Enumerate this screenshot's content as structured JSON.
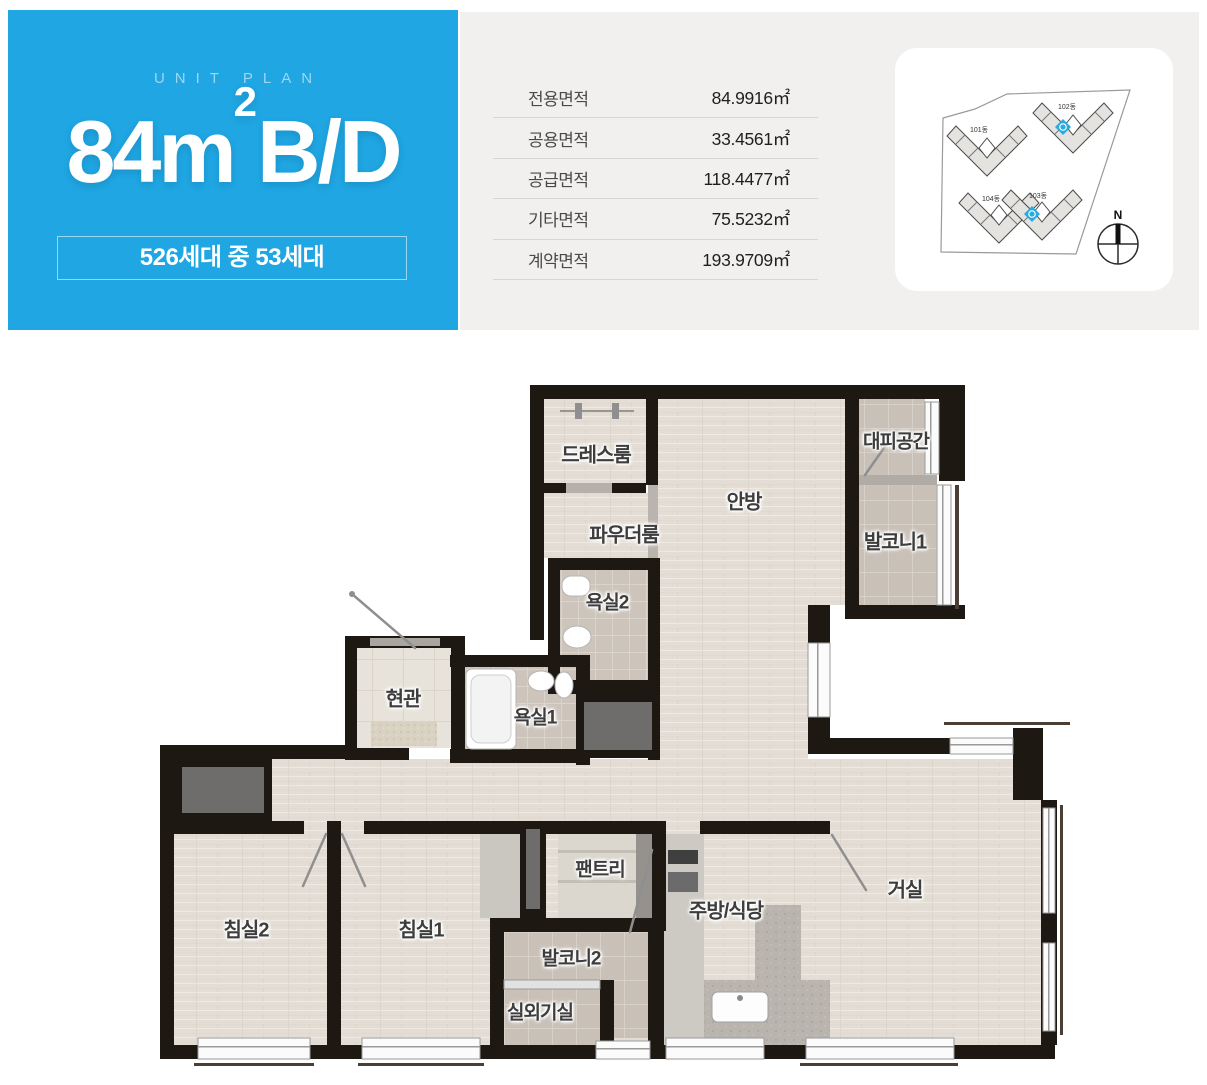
{
  "header": {
    "eyebrow": "UNIT PLAN",
    "unit_name": {
      "base": "84m",
      "sup": "2",
      "suffix": "B/D"
    },
    "badge": "526세대 중 53세대",
    "accent_color": "#1fa6e3"
  },
  "area_table": {
    "rows": [
      {
        "label": "전용면적",
        "value": "84.9916㎡"
      },
      {
        "label": "공용면적",
        "value": "33.4561㎡"
      },
      {
        "label": "공급면적",
        "value": "118.4477㎡"
      },
      {
        "label": "기타면적",
        "value": "75.5232㎡"
      },
      {
        "label": "계약면적",
        "value": "193.9709㎡"
      }
    ]
  },
  "site_plan": {
    "buildings": [
      {
        "name": "101동",
        "highlighted": false
      },
      {
        "name": "102동",
        "highlighted": true
      },
      {
        "name": "104동",
        "highlighted": false
      },
      {
        "name": "103동",
        "highlighted": true
      }
    ],
    "compass": "N",
    "highlight_color": "#29abe2"
  },
  "floor_plan": {
    "rooms": [
      {
        "name": "드레스룸"
      },
      {
        "name": "대피공간"
      },
      {
        "name": "안방"
      },
      {
        "name": "파우더룸"
      },
      {
        "name": "발코니1"
      },
      {
        "name": "욕실2"
      },
      {
        "name": "현관"
      },
      {
        "name": "욕실1"
      },
      {
        "name": "팬트리"
      },
      {
        "name": "침실2"
      },
      {
        "name": "침실1"
      },
      {
        "name": "발코니2"
      },
      {
        "name": "주방/식당"
      },
      {
        "name": "거실"
      },
      {
        "name": "실외기실"
      }
    ]
  }
}
